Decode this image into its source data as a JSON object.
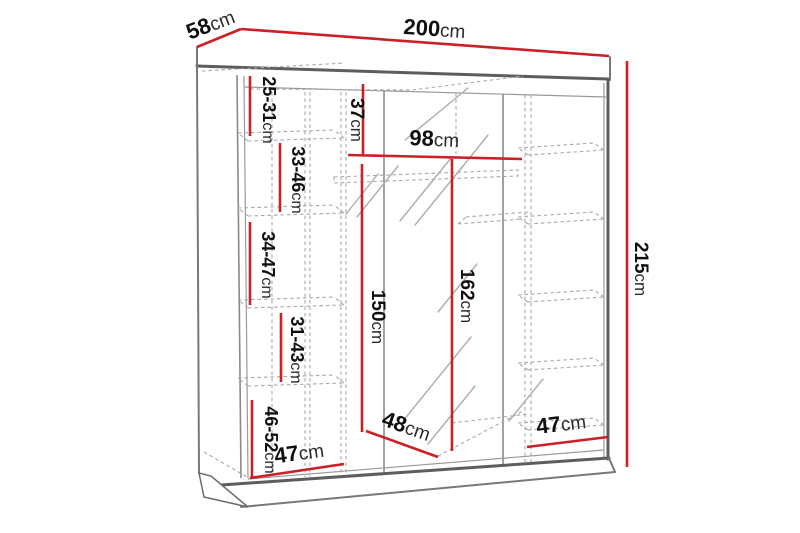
{
  "diagram": {
    "kind": "wardrobe-dimension-drawing",
    "unit": "cm",
    "accent_color": "#cb2026",
    "structure_color": "#5d5d5d",
    "background_color": "#ffffff"
  },
  "dimensions": {
    "width": {
      "value": "200",
      "unit": "cm"
    },
    "depth": {
      "value": "58",
      "unit": "cm"
    },
    "height": {
      "value": "215",
      "unit": "cm"
    },
    "top_shelf_spacing": {
      "value": "25-31",
      "unit": "cm"
    },
    "upper_left_shelf_spacing": {
      "value": "33-46",
      "unit": "cm"
    },
    "top_section_height": {
      "value": "37",
      "unit": "cm"
    },
    "middle_inner_width": {
      "value": "98",
      "unit": "cm"
    },
    "middle_left_shelf_spacing": {
      "value": "34-47",
      "unit": "cm"
    },
    "lower_left_shelf_spacing": {
      "value": "31-43",
      "unit": "cm"
    },
    "hanging_space_height": {
      "value": "150",
      "unit": "cm"
    },
    "mirror_door_height": {
      "value": "162",
      "unit": "cm"
    },
    "bottom_shelf_spacing": {
      "value": "46-52",
      "unit": "cm"
    },
    "left_section_width": {
      "value": "47",
      "unit": "cm"
    },
    "middle_section_depth": {
      "value": "48",
      "unit": "cm"
    },
    "right_section_width": {
      "value": "47",
      "unit": "cm"
    }
  }
}
